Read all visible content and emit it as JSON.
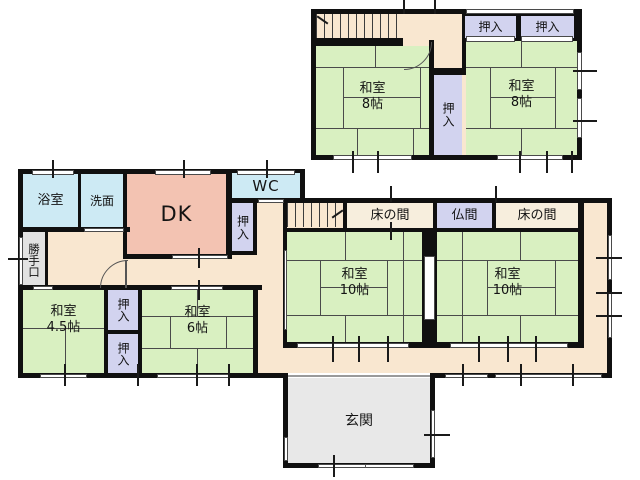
{
  "floor2": {
    "oshiire_top_a": "押入",
    "oshiire_top_b": "押入",
    "washitsu_left": {
      "name": "和室",
      "size": "8帖"
    },
    "oshiire_center": "押入",
    "washitsu_right": {
      "name": "和室",
      "size": "8帖"
    }
  },
  "floor1": {
    "bathroom": "浴室",
    "washroom": "洗面",
    "dk": "DK",
    "wc": "WC",
    "oshiire_hall": "押入",
    "katteguchi": "勝手口",
    "tokonoma_left": "床の間",
    "butsuma": "仏間",
    "tokonoma_right": "床の間",
    "washitsu10_left": {
      "name": "和室",
      "size": "10帖"
    },
    "washitsu10_right": {
      "name": "和室",
      "size": "10帖"
    },
    "washitsu45": {
      "name": "和室",
      "size": "4.5帖"
    },
    "oshiire_sw_top": "押入",
    "oshiire_sw_bottom": "押入",
    "washitsu6": {
      "name": "和室",
      "size": "6帖"
    },
    "genkan": "玄関"
  },
  "colors": {
    "tatami_room": "#d9f0c1",
    "closet": "#d2d3ef",
    "hall": "#f9e7d0",
    "dk": "#f3c3b2",
    "wet_area": "#cdeaf4",
    "genkan": "#e8e8e8",
    "tokonoma": "#f7eedd",
    "wall": "#101010"
  }
}
